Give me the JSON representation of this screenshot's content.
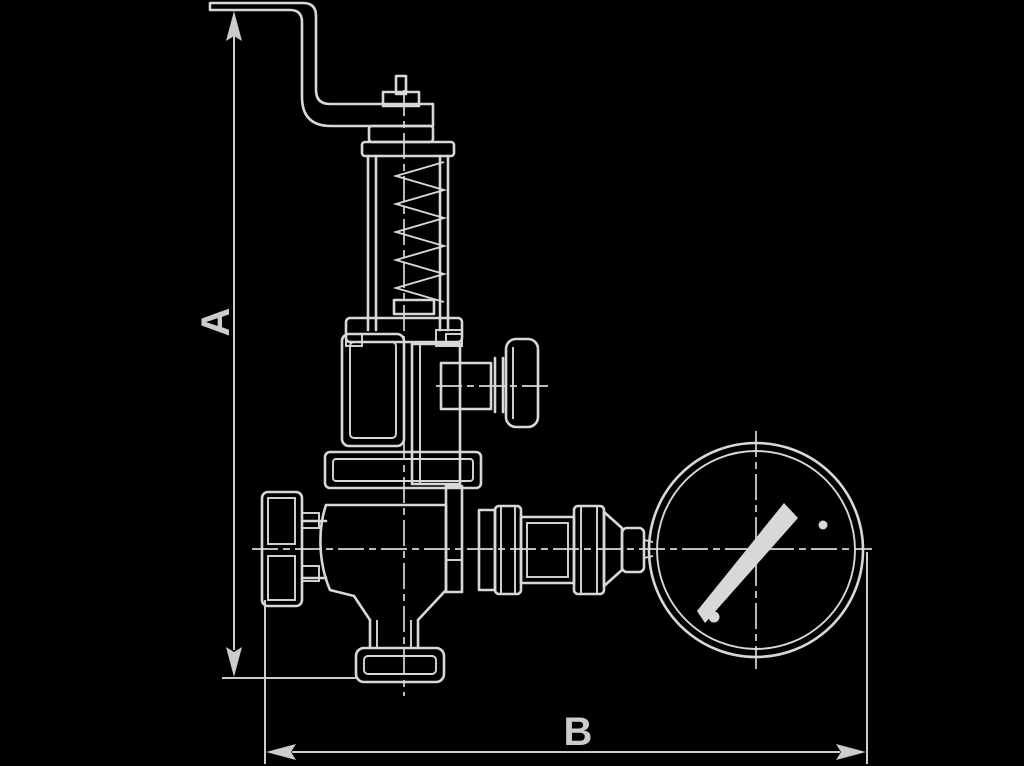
{
  "page": {
    "background": "#000000",
    "ink": "#d8d8d8",
    "dim_color": "#cccccc"
  },
  "drawing": {
    "type": "technical-dimension-drawing",
    "subject": "angle safety relief valve with lifting lever, side test knob and pressure gauge, side elevation",
    "labels": {
      "a": "A",
      "b": "B"
    },
    "parts": [
      "lifting-lever",
      "spindle-fork",
      "bonnet-cap",
      "spring-bonnet",
      "spring-coil",
      "bell-housing",
      "body-flange",
      "inlet-union",
      "valve-body",
      "outlet-flange",
      "test-knob",
      "gauge-piping",
      "pressure-gauge",
      "gauge-needle"
    ]
  }
}
